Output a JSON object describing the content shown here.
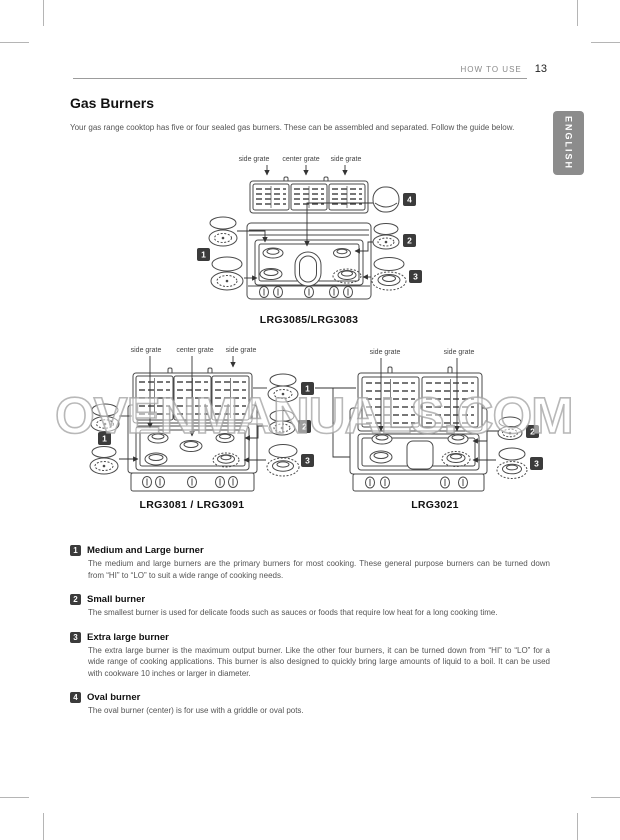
{
  "page": {
    "header": {
      "section": "HOW TO USE",
      "page_number": "13"
    },
    "language_tab": "ENGLISH",
    "title": "Gas Burners",
    "intro": "Your gas range cooktop has five or four sealed gas burners. These can be assembled and separated. Follow the guide below.",
    "watermark": "OVENMANUALS.COM"
  },
  "diagrams": {
    "top": {
      "caption": "LRG3085/LRG3083",
      "labels": {
        "left": "side grate",
        "center": "center grate",
        "right": "side grate"
      },
      "markers": {
        "m1": "1",
        "m2": "2",
        "m3": "3",
        "m4": "4"
      }
    },
    "bottom_left": {
      "caption": "LRG3081 / LRG3091",
      "labels": {
        "left": "side grate",
        "center": "center grate",
        "right": "side grate"
      },
      "markers": {
        "left1": "1",
        "m1": "1",
        "m2": "2",
        "m3": "3"
      }
    },
    "bottom_right": {
      "caption": "LRG3021",
      "labels": {
        "left": "side grate",
        "right": "side grate"
      },
      "markers": {
        "m2": "2",
        "m3": "3"
      }
    }
  },
  "legend": {
    "items": [
      {
        "number": "1",
        "title": "Medium and Large burner",
        "body": "The medium and large burners are the primary burners for most cooking. These general purpose burners can be turned down from “HI” to “LO” to suit a wide range of cooking needs."
      },
      {
        "number": "2",
        "title": "Small burner",
        "body": "The smallest burner is used for delicate foods such as sauces or foods that require low heat for a long cooking time."
      },
      {
        "number": "3",
        "title": "Extra large burner",
        "body": "The extra large burner is the maximum output burner. Like the other four burners, it can be turned down from “HI” to “LO” for a wide range of cooking applications. This burner is also designed to quickly bring large amounts of liquid to a boil. It can be used with cookware 10 inches or larger in diameter."
      },
      {
        "number": "4",
        "title": "Oval burner",
        "body": "The oval burner (center) is for use with a griddle or oval pots."
      }
    ]
  }
}
